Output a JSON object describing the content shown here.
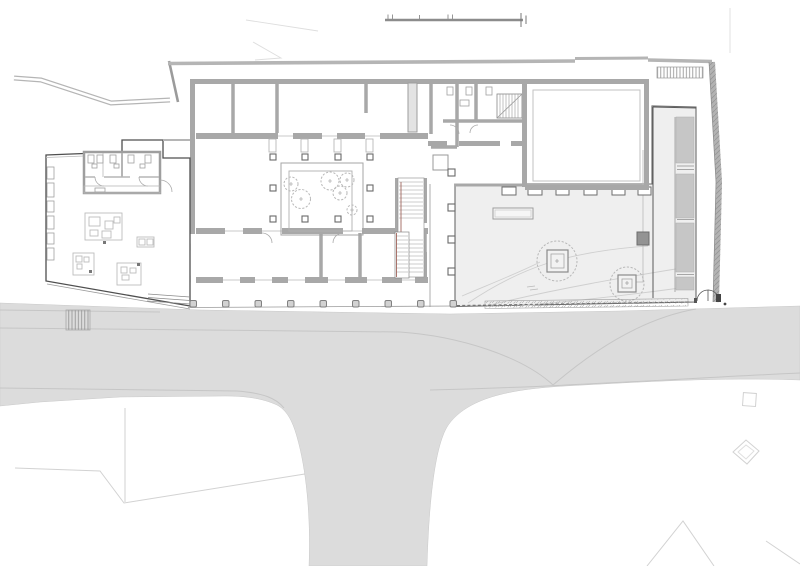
{
  "drawing": {
    "type": "architectural-site-plan-ground-floor",
    "palette": {
      "background": "#ffffff",
      "road_fill": "#dcdcdc",
      "terrace_fill": "#efefef",
      "ramp_fill": "#c6c6c6",
      "column_fill": "#d2d2d2",
      "dark_square_fill": "#939393",
      "wall_gray": "#a8a8a8",
      "outline_dark": "#4f4f4f",
      "stair_rail_accent": "#a1665c",
      "faint_line": "#d2d2d2",
      "hatch_line": "#8f8f8f"
    },
    "features": {
      "scale_bar": {
        "tick_marks": 6
      },
      "courtyard": {
        "perimeter_columns": 10,
        "trees": 6
      },
      "south_colonnade": {
        "columns": 9
      },
      "east_gallery": {
        "columns": 4
      },
      "terrace": {
        "tree_planters": 2,
        "flow_lines": 4,
        "wall_teeth": 6,
        "benches": 1
      },
      "ramp": {
        "segments": 4
      },
      "toilet_block": {
        "stalls": 2,
        "fixtures": 5
      },
      "furniture_groups": 4,
      "exterior_stairs": 2,
      "gates": 1
    }
  }
}
